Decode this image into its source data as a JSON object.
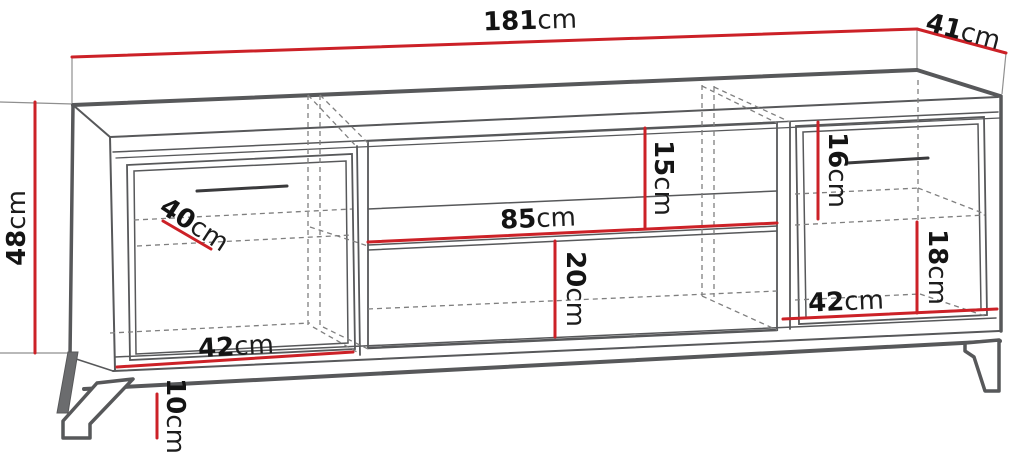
{
  "meta": {
    "description": "Dimension diagram of a TV cabinet with two doors, open middle shelf section and metal legs"
  },
  "diagram": {
    "accent_color": "#cc2127",
    "line_color": "#57585a",
    "unit": "cm",
    "dimensions": [
      {
        "name": "overall-width",
        "num": "181",
        "unit": "cm"
      },
      {
        "name": "overall-depth",
        "num": "41",
        "unit": "cm"
      },
      {
        "name": "body-height",
        "num": "48",
        "unit": "cm"
      },
      {
        "name": "inner-shelf-depth",
        "num": "40",
        "unit": "cm"
      },
      {
        "name": "middle-upper-opening-height",
        "num": "15",
        "unit": "cm"
      },
      {
        "name": "middle-opening-width",
        "num": "85",
        "unit": "cm"
      },
      {
        "name": "middle-lower-opening-height",
        "num": "20",
        "unit": "cm"
      },
      {
        "name": "right-upper-compartment-height",
        "num": "16",
        "unit": "cm"
      },
      {
        "name": "right-lower-compartment-height",
        "num": "18",
        "unit": "cm"
      },
      {
        "name": "right-compartment-width",
        "num": "42",
        "unit": "cm"
      },
      {
        "name": "left-compartment-width",
        "num": "42",
        "unit": "cm"
      },
      {
        "name": "leg-height",
        "num": "10",
        "unit": "cm"
      }
    ]
  }
}
